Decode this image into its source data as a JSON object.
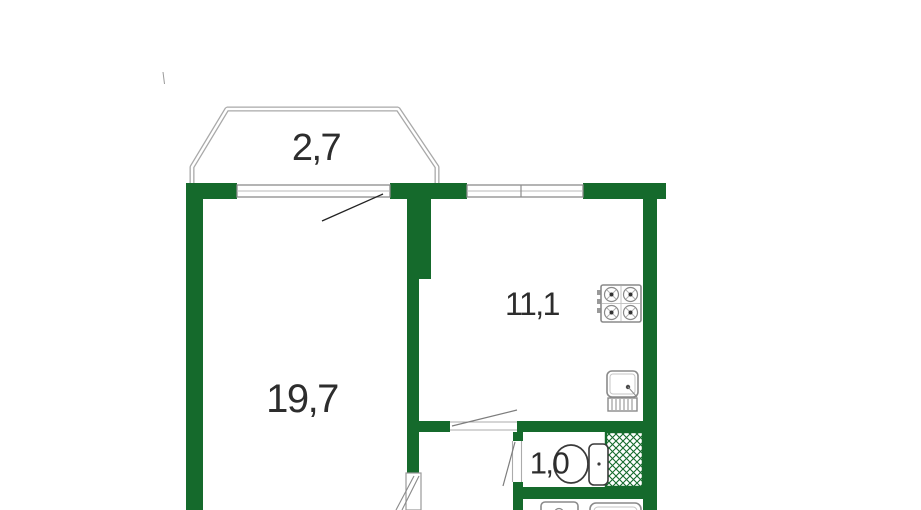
{
  "plan": {
    "type": "apartment-floor-plan",
    "colors": {
      "wall": "#156a2c",
      "line": "#9c9c9c",
      "dark": "#2e2e2e",
      "label": "#2d2d2d",
      "bg": "#ffffff"
    },
    "rooms": {
      "balcony": {
        "label": "2,7"
      },
      "living_room": {
        "label": "19,7"
      },
      "kitchen": {
        "label": "11,1"
      },
      "wc": {
        "label": "1,0"
      }
    },
    "fixtures": [
      "stove-icon",
      "kitchen-sink-icon",
      "toilet-icon",
      "washbasin-icon",
      "bathtub-icon",
      "vent-shaft-hatch"
    ]
  }
}
